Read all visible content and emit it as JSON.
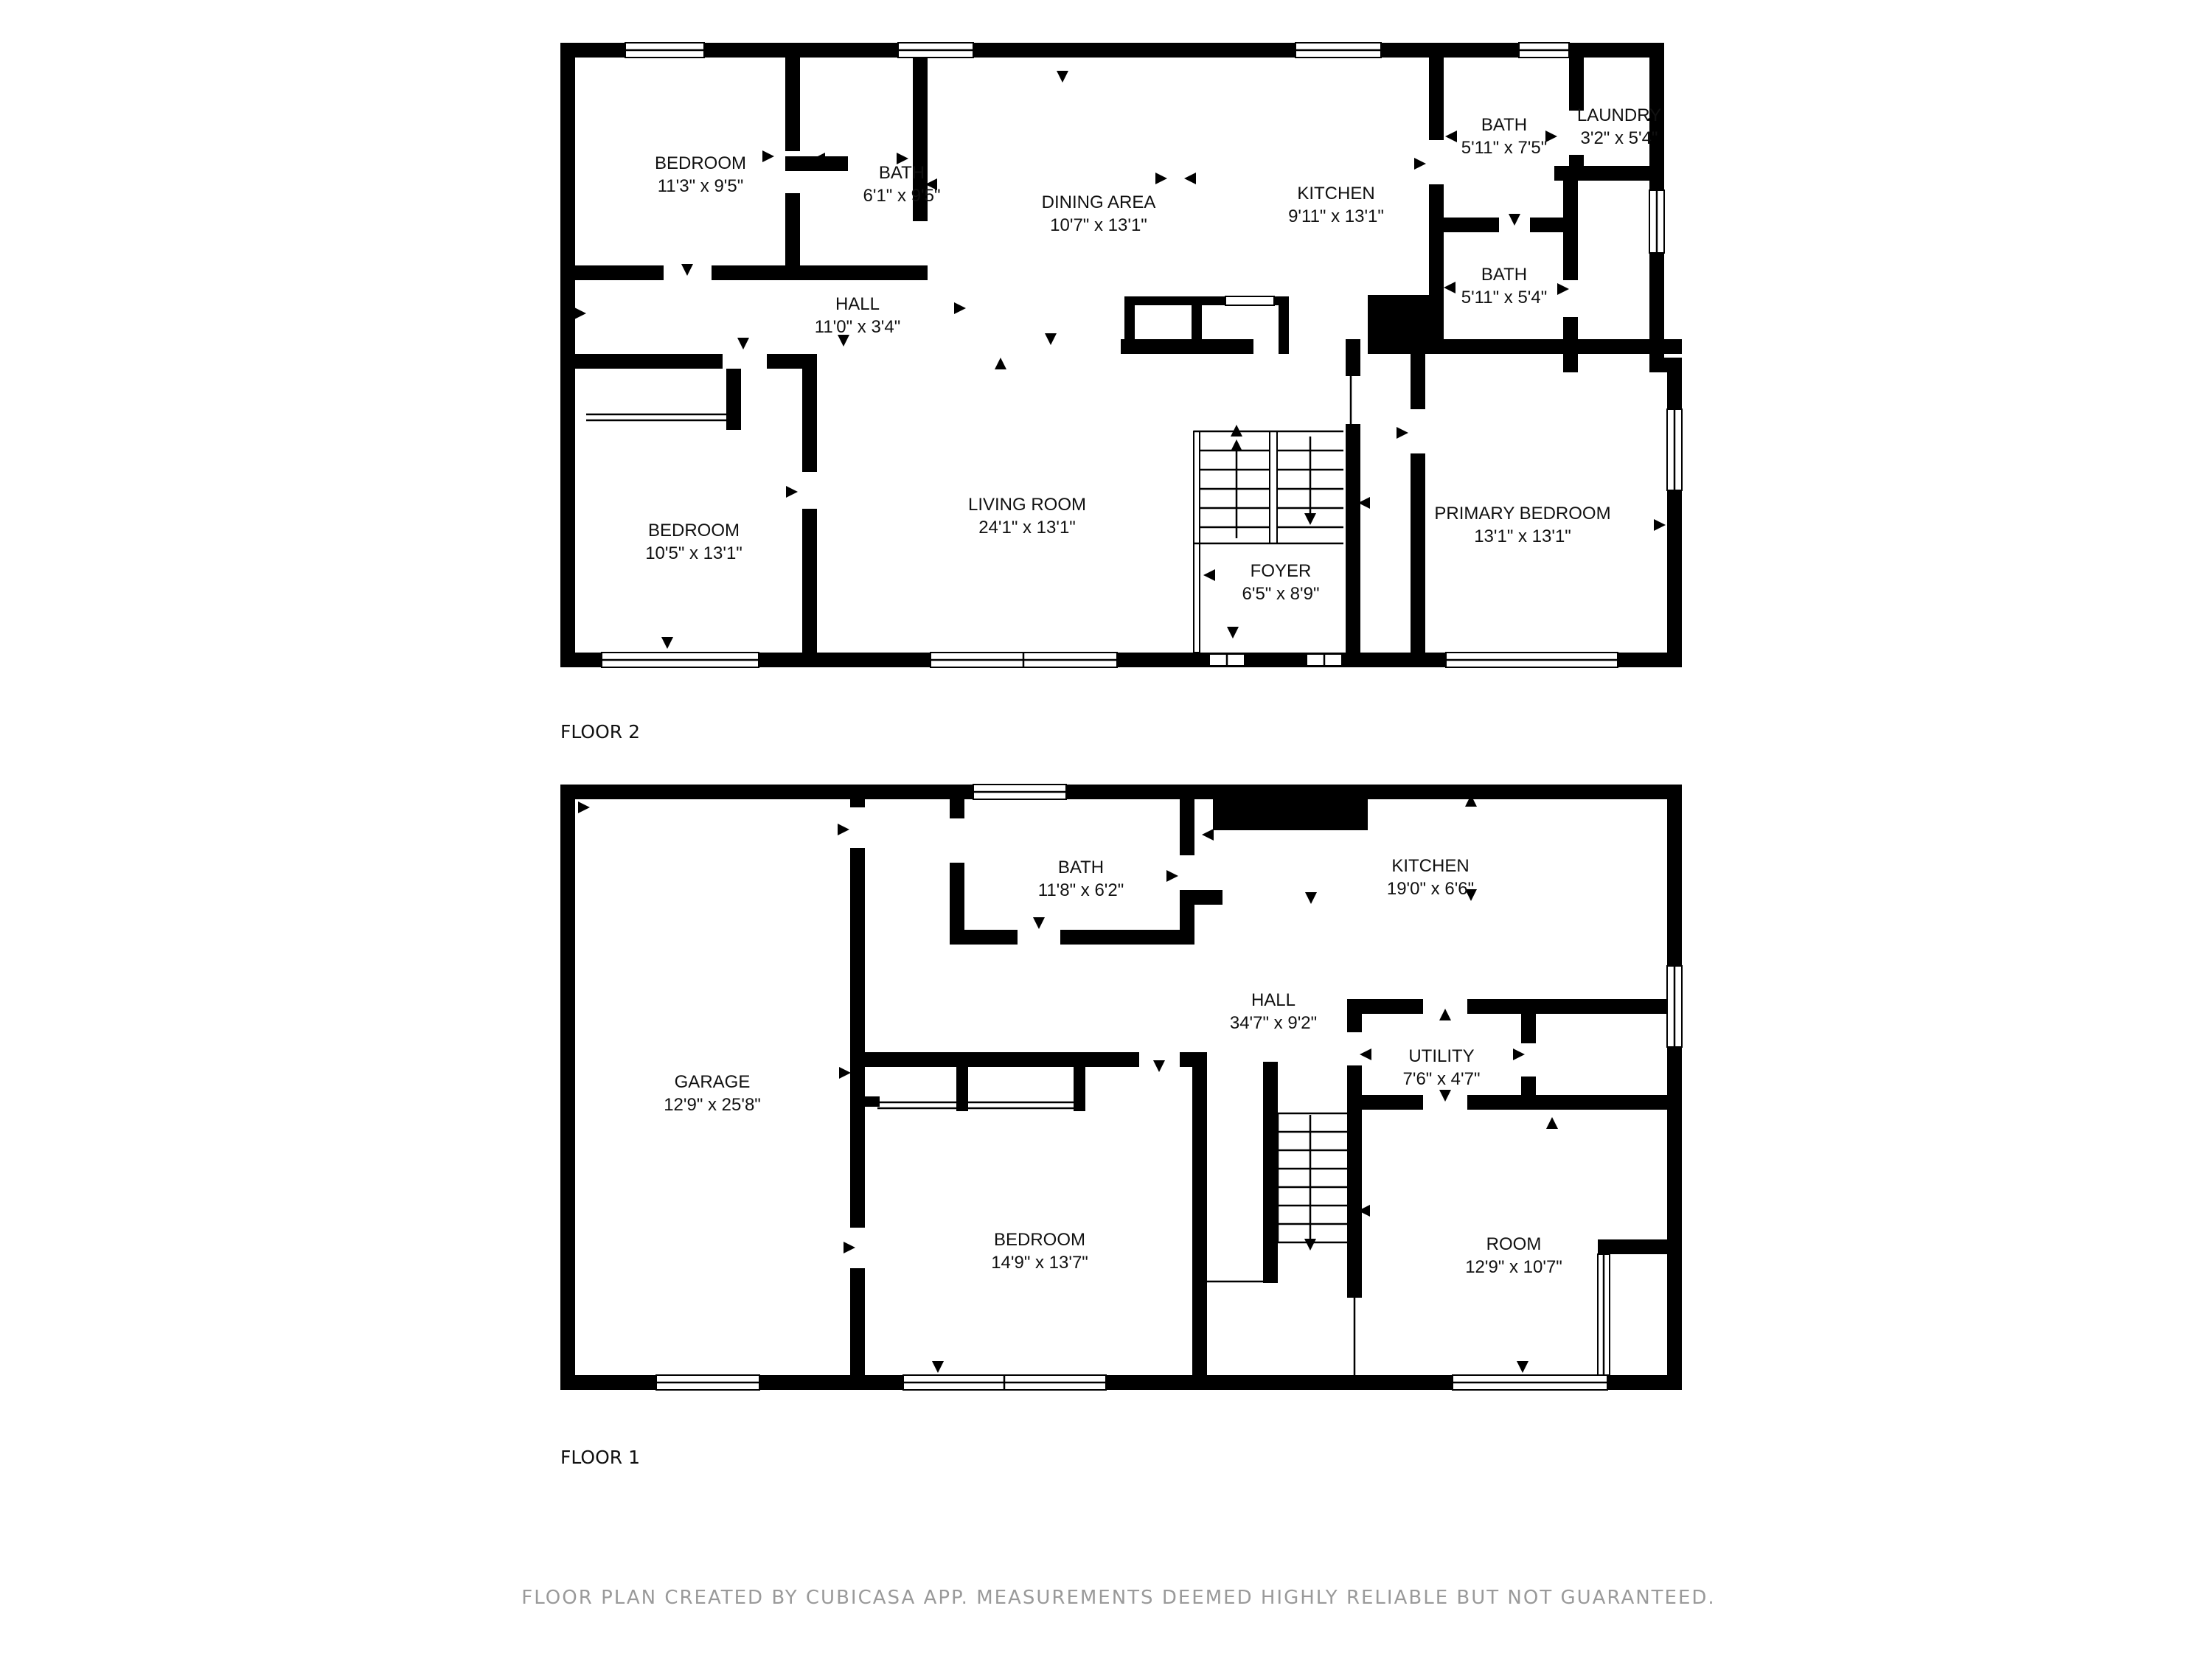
{
  "page": {
    "background": "#ffffff"
  },
  "colors": {
    "wall": "#000000",
    "room_text": "#111111",
    "footer_text": "#9a9a9a"
  },
  "footer": {
    "text": "FLOOR PLAN CREATED BY CUBICASA APP. MEASUREMENTS DEEMED HIGHLY RELIABLE BUT NOT GUARANTEED."
  },
  "floors": [
    {
      "label": "FLOOR 2",
      "rooms": [
        {
          "name": "BEDROOM",
          "dims": "11'3\" x 9'5\""
        },
        {
          "name": "BATH",
          "dims": "6'1\" x 9'5\""
        },
        {
          "name": "DINING AREA",
          "dims": "10'7\" x 13'1\""
        },
        {
          "name": "KITCHEN",
          "dims": "9'11\" x 13'1\""
        },
        {
          "name": "BATH",
          "dims": "5'11\" x 7'5\""
        },
        {
          "name": "LAUNDRY",
          "dims": "3'2\" x 5'4\""
        },
        {
          "name": "BATH",
          "dims": "5'11\" x 5'4\""
        },
        {
          "name": "HALL",
          "dims": "11'0\" x 3'4\""
        },
        {
          "name": "BEDROOM",
          "dims": "10'5\" x 13'1\""
        },
        {
          "name": "LIVING ROOM",
          "dims": "24'1\" x 13'1\""
        },
        {
          "name": "FOYER",
          "dims": "6'5\" x 8'9\""
        },
        {
          "name": "PRIMARY BEDROOM",
          "dims": "13'1\" x 13'1\""
        }
      ]
    },
    {
      "label": "FLOOR 1",
      "rooms": [
        {
          "name": "BATH",
          "dims": "11'8\" x 6'2\""
        },
        {
          "name": "KITCHEN",
          "dims": "19'0\" x 6'6\""
        },
        {
          "name": "HALL",
          "dims": "34'7\" x 9'2\""
        },
        {
          "name": "UTILITY",
          "dims": "7'6\" x 4'7\""
        },
        {
          "name": "GARAGE",
          "dims": "12'9\" x 25'8\""
        },
        {
          "name": "BEDROOM",
          "dims": "14'9\" x 13'7\""
        },
        {
          "name": "ROOM",
          "dims": "12'9\" x 10'7\""
        }
      ]
    }
  ]
}
